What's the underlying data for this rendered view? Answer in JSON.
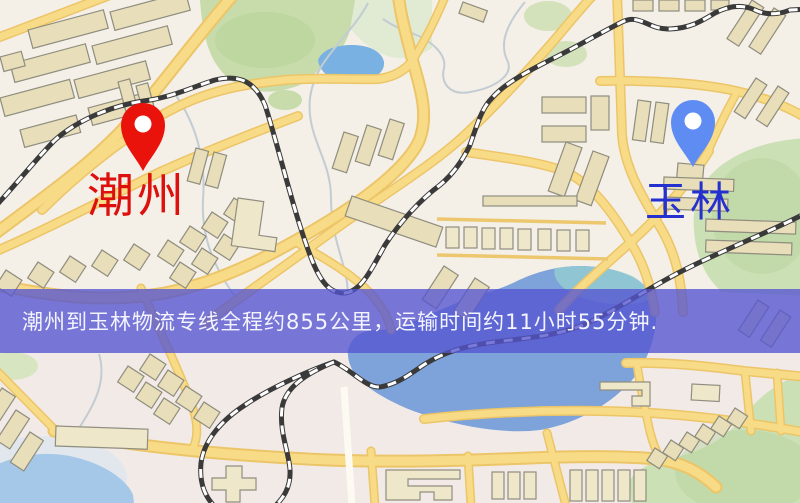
{
  "map": {
    "banner_text": "潮州到玉林物流专线全程约855公里，运输时间约11小时55分钟.",
    "banner": {
      "background": "#5454d1",
      "text_color": "#f4f4ff"
    },
    "origin_label": "潮州",
    "destination_label": "玉林",
    "markers": [
      {
        "name": "origin",
        "label": "潮州",
        "pin_color": "#e9130c",
        "label_color": "#dd100d"
      },
      {
        "name": "destination",
        "label": "玉林",
        "pin_color": "#5e8cf2",
        "label_color": "#2431ce"
      }
    ],
    "route": {
      "distance_text": "约855公里",
      "duration_text": "约11小时55分钟"
    },
    "palette": {
      "background": "#f4efe7",
      "road": "#f8db86",
      "road_casing": "#ecc568",
      "park": "#c7dcaa",
      "water": "#7da3da",
      "building": "#e8deba",
      "railway": "#3a3a3a"
    }
  }
}
